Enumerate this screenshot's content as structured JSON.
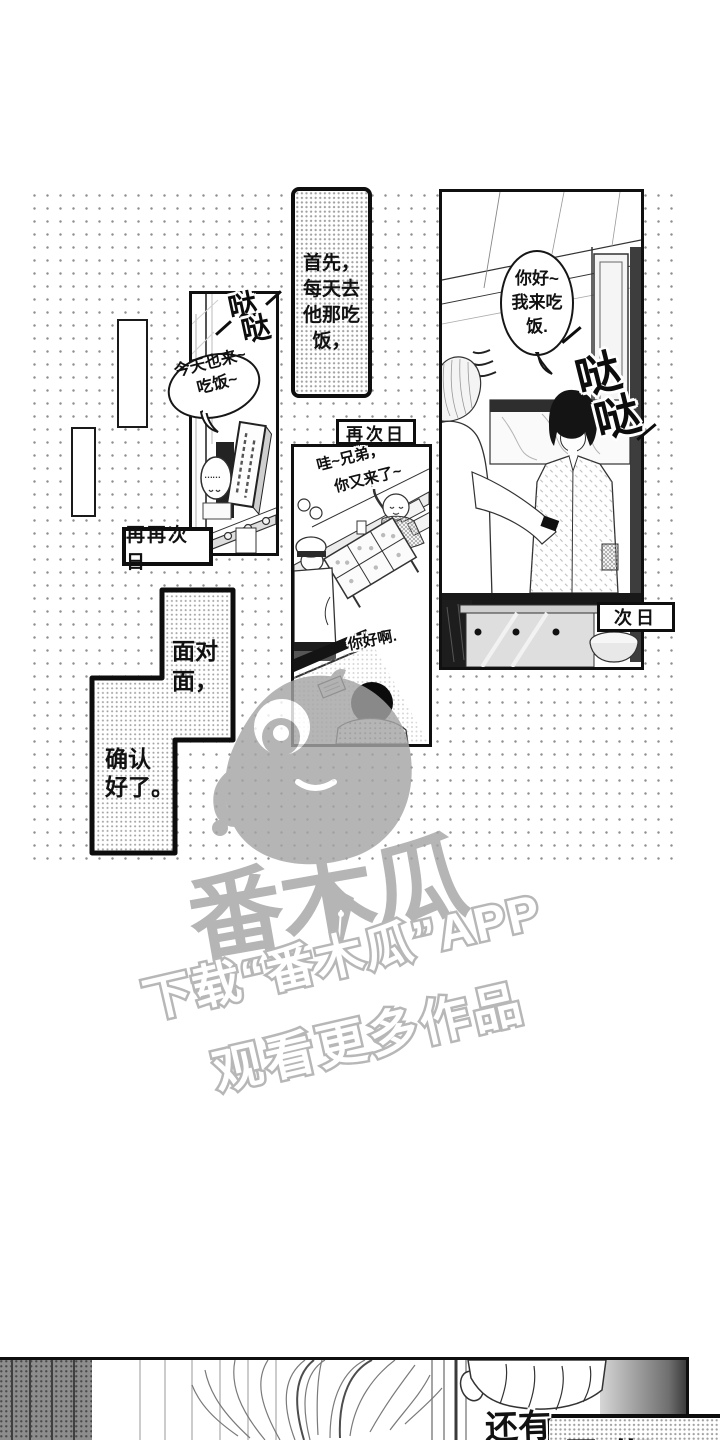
{
  "colors": {
    "ink": "#111111",
    "paper": "#ffffff",
    "watermark_gray": "#a5a5a5",
    "dot_gray": "#8f8f8f"
  },
  "sfx": {
    "street": {
      "char1": "哒",
      "char2": "哒"
    },
    "diner": {
      "char1": "哒",
      "char2": "哒"
    }
  },
  "street_panel": {
    "bubble_line1": "今天也来~",
    "bubble_line2": "吃饭~",
    "blob_dots": "……"
  },
  "intro_caption": {
    "lines": [
      "首先，",
      "每天去",
      "他那吃",
      "饭，"
    ]
  },
  "labels": {
    "again_next_day": "再次日",
    "again_again_next_day": "再再次日",
    "next_day": "次日"
  },
  "diner_panel": {
    "bubble_line1": "你好~",
    "bubble_line2": "我来吃",
    "bubble_line3": "饭."
  },
  "food_panel": {
    "greet_line1": "哇~兄弟，",
    "greet_line2": "你又来了~",
    "hello": "你好啊."
  },
  "face_caption": {
    "lines": [
      "面对",
      "面，",
      "确认",
      "好了。"
    ]
  },
  "watermark": {
    "logo_text": "番木瓜",
    "download_line": "下载“番木瓜”APP",
    "watch_line": "观看更多作品"
  },
  "bottom_panel": {
    "overlay_text": "还有",
    "caption": "星期日"
  }
}
